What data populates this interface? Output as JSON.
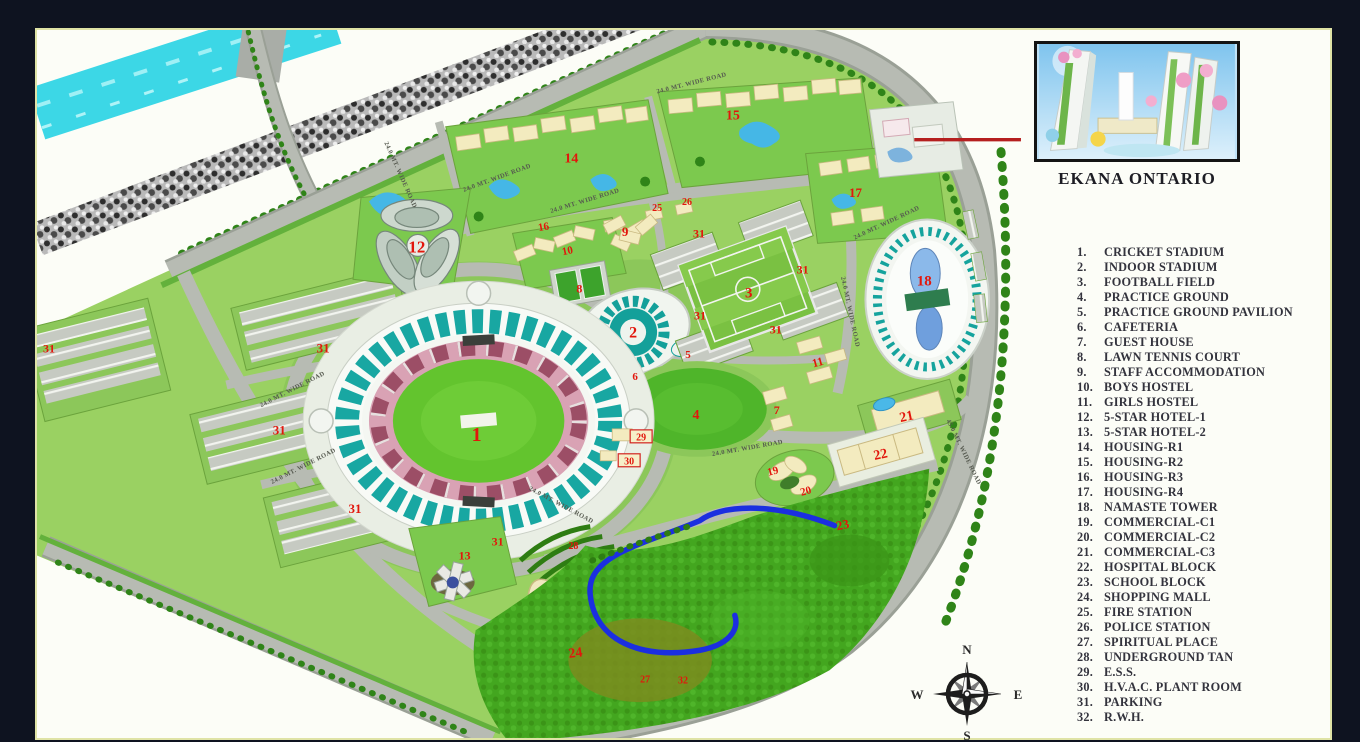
{
  "inset": {
    "caption": "EKANA ONTARIO"
  },
  "compass": {
    "north": "N",
    "east": "E",
    "south": "S",
    "west": "W"
  },
  "legend": {
    "items": [
      {
        "num": "1.",
        "label": "CRICKET STADIUM"
      },
      {
        "num": "2.",
        "label": "INDOOR STADIUM"
      },
      {
        "num": "3.",
        "label": "FOOTBALL FIELD"
      },
      {
        "num": "4.",
        "label": "PRACTICE GROUND"
      },
      {
        "num": "5.",
        "label": "PRACTICE GROUND PAVILION"
      },
      {
        "num": "6.",
        "label": "CAFETERIA"
      },
      {
        "num": "7.",
        "label": "GUEST HOUSE"
      },
      {
        "num": "8.",
        "label": "LAWN TENNIS COURT"
      },
      {
        "num": "9.",
        "label": "STAFF ACCOMMODATION"
      },
      {
        "num": "10.",
        "label": "BOYS HOSTEL"
      },
      {
        "num": "11.",
        "label": "GIRLS HOSTEL"
      },
      {
        "num": "12.",
        "label": "5-STAR HOTEL-1"
      },
      {
        "num": "13.",
        "label": "5-STAR HOTEL-2"
      },
      {
        "num": "14.",
        "label": "HOUSING-R1"
      },
      {
        "num": "15.",
        "label": "HOUSING-R2"
      },
      {
        "num": "16.",
        "label": "HOUSING-R3"
      },
      {
        "num": "17.",
        "label": "HOUSING-R4"
      },
      {
        "num": "18.",
        "label": "NAMASTE TOWER"
      },
      {
        "num": "19.",
        "label": "COMMERCIAL-C1"
      },
      {
        "num": "20.",
        "label": "COMMERCIAL-C2"
      },
      {
        "num": "21.",
        "label": "COMMERCIAL-C3"
      },
      {
        "num": "22.",
        "label": "HOSPITAL BLOCK"
      },
      {
        "num": "23.",
        "label": "SCHOOL BLOCK"
      },
      {
        "num": "24.",
        "label": "SHOPPING MALL"
      },
      {
        "num": "25.",
        "label": "FIRE STATION"
      },
      {
        "num": "26.",
        "label": "POLICE STATION"
      },
      {
        "num": "27.",
        "label": "SPIRITUAL PLACE"
      },
      {
        "num": "28.",
        "label": "UNDERGROUND TAN"
      },
      {
        "num": "29.",
        "label": "E.S.S."
      },
      {
        "num": "30.",
        "label": "H.V.A.C. PLANT ROOM"
      },
      {
        "num": "31.",
        "label": "PARKING"
      },
      {
        "num": "32.",
        "label": "R.W.H."
      }
    ]
  },
  "map": {
    "colors": {
      "water": "#3cd7e6",
      "stream": "#1b2fe0",
      "road": "#b7bbb3",
      "grass": "#9ad162",
      "forest": "#43a61f",
      "teal": "#15a39d",
      "seat_pink": "#d895ab",
      "seat_maroon": "#8c3a52",
      "building_cream": "#f3ebbf",
      "marker_red": "#e2160c",
      "callout_red": "#b51f1f"
    },
    "road_labels": [
      {
        "text": "24.0 MT. WIDE ROAD",
        "x": 585,
        "y": 201,
        "rot": -17
      },
      {
        "text": "24.0 MT. WIDE ROAD",
        "x": 692,
        "y": 83,
        "rot": -14
      },
      {
        "text": "24.0 MT. WIDE ROAD",
        "x": 497,
        "y": 178,
        "rot": -20
      },
      {
        "text": "24.0 MT. WIDE ROAD",
        "x": 292,
        "y": 390,
        "rot": -27
      },
      {
        "text": "24.0 MT. WIDE ROAD",
        "x": 303,
        "y": 467,
        "rot": -27
      },
      {
        "text": "24.0 MT. WIDE ROAD",
        "x": 560,
        "y": 506,
        "rot": 28
      },
      {
        "text": "24.0 MT. WIDE ROAD",
        "x": 748,
        "y": 449,
        "rot": -10
      },
      {
        "text": "24.0 MT. WIDE ROAD",
        "x": 849,
        "y": 311,
        "rot": 78
      },
      {
        "text": "24.0 MT. WIDE ROAD",
        "x": 888,
        "y": 223,
        "rot": -25
      },
      {
        "text": "24.0 MT. WIDE ROAD",
        "x": 398,
        "y": 174,
        "rot": 66
      },
      {
        "text": "45.0 MT. WIDE ROAD",
        "x": 963,
        "y": 452,
        "rot": 64
      }
    ],
    "markers": [
      {
        "n": "1",
        "x": 476,
        "y": 433,
        "s": 20
      },
      {
        "n": "2",
        "x": 633,
        "y": 331,
        "s": 16
      },
      {
        "n": "3",
        "x": 749,
        "y": 291,
        "s": 15
      },
      {
        "n": "4",
        "x": 696,
        "y": 413,
        "s": 14
      },
      {
        "n": "5",
        "x": 688,
        "y": 353,
        "s": 11
      },
      {
        "n": "6",
        "x": 635,
        "y": 375,
        "s": 11
      },
      {
        "n": "7",
        "x": 777,
        "y": 409,
        "s": 12
      },
      {
        "n": "8",
        "x": 579,
        "y": 287,
        "s": 12
      },
      {
        "n": "9",
        "x": 625,
        "y": 230,
        "s": 13
      },
      {
        "n": "10",
        "x": 567,
        "y": 249,
        "s": 11,
        "rot": -12
      },
      {
        "n": "11",
        "x": 818,
        "y": 361,
        "s": 12,
        "rot": -15
      },
      {
        "n": "12",
        "x": 416,
        "y": 245,
        "s": 17
      },
      {
        "n": "13",
        "x": 464,
        "y": 555,
        "s": 12
      },
      {
        "n": "14",
        "x": 571,
        "y": 156,
        "s": 14
      },
      {
        "n": "15",
        "x": 733,
        "y": 113,
        "s": 14
      },
      {
        "n": "16",
        "x": 543,
        "y": 225,
        "s": 11,
        "rot": -10
      },
      {
        "n": "17",
        "x": 856,
        "y": 191,
        "s": 13
      },
      {
        "n": "18",
        "x": 925,
        "y": 279,
        "s": 15
      },
      {
        "n": "19",
        "x": 773,
        "y": 470,
        "s": 11,
        "rot": -15
      },
      {
        "n": "20",
        "x": 806,
        "y": 490,
        "s": 11,
        "rot": -15
      },
      {
        "n": "21",
        "x": 907,
        "y": 415,
        "s": 14,
        "rot": -12
      },
      {
        "n": "22",
        "x": 881,
        "y": 453,
        "s": 14,
        "rot": -12
      },
      {
        "n": "23",
        "x": 843,
        "y": 524,
        "s": 13,
        "rot": -12
      },
      {
        "n": "24",
        "x": 575,
        "y": 652,
        "s": 14,
        "rot": -8
      },
      {
        "n": "25",
        "x": 657,
        "y": 206,
        "s": 10
      },
      {
        "n": "26",
        "x": 687,
        "y": 200,
        "s": 10
      },
      {
        "n": "27",
        "x": 645,
        "y": 679,
        "s": 10
      },
      {
        "n": "28",
        "x": 573,
        "y": 545,
        "s": 10
      },
      {
        "n": "29",
        "x": 641,
        "y": 436,
        "s": 10,
        "boxed": true
      },
      {
        "n": "30",
        "x": 629,
        "y": 460,
        "s": 10,
        "boxed": true
      },
      {
        "n": "31",
        "x": 322,
        "y": 347,
        "s": 13
      },
      {
        "n": "31",
        "x": 278,
        "y": 429,
        "s": 13
      },
      {
        "n": "31",
        "x": 354,
        "y": 508,
        "s": 13
      },
      {
        "n": "31",
        "x": 47,
        "y": 347,
        "s": 12
      },
      {
        "n": "31",
        "x": 497,
        "y": 541,
        "s": 12
      },
      {
        "n": "31",
        "x": 699,
        "y": 232,
        "s": 12
      },
      {
        "n": "31",
        "x": 803,
        "y": 268,
        "s": 12
      },
      {
        "n": "31",
        "x": 700,
        "y": 314,
        "s": 12
      },
      {
        "n": "31",
        "x": 776,
        "y": 328,
        "s": 12
      },
      {
        "n": "32",
        "x": 683,
        "y": 680,
        "s": 10
      }
    ]
  }
}
